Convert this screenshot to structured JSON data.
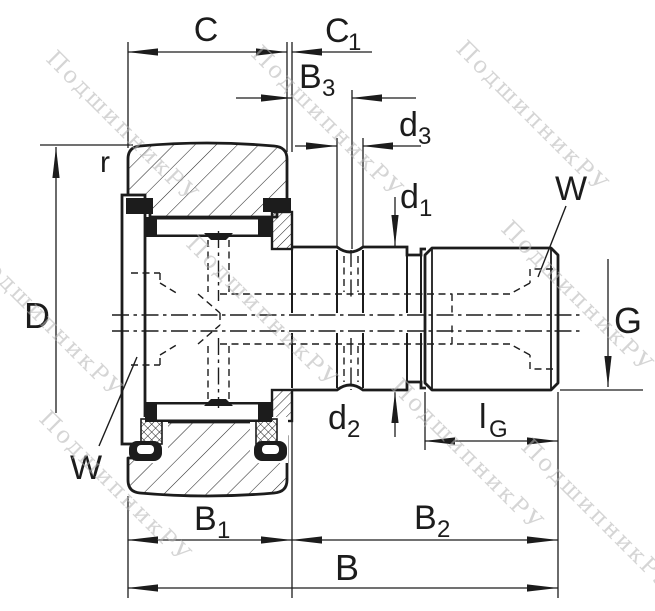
{
  "drawing": {
    "watermark": "ПодшипникРУ",
    "labels": {
      "C": {
        "main": "C",
        "sub": ""
      },
      "C1": {
        "main": "C",
        "sub": "1"
      },
      "B3": {
        "main": "B",
        "sub": "3"
      },
      "d3": {
        "main": "d",
        "sub": "3"
      },
      "d1": {
        "main": "d",
        "sub": "1"
      },
      "d2": {
        "main": "d",
        "sub": "2"
      },
      "lG": {
        "main": "l",
        "sub": "G"
      },
      "B1": {
        "main": "B",
        "sub": "1"
      },
      "B2": {
        "main": "B",
        "sub": "2"
      },
      "B": {
        "main": "B",
        "sub": ""
      },
      "D": {
        "main": "D",
        "sub": ""
      },
      "G": {
        "main": "G",
        "sub": ""
      },
      "r": {
        "main": "r",
        "sub": ""
      },
      "W_top": {
        "main": "W",
        "sub": ""
      },
      "W_bottom": {
        "main": "W",
        "sub": ""
      }
    },
    "colors": {
      "line": "#1c1c1c",
      "watermark": "#b3b3b3",
      "background": "#ffffff"
    }
  }
}
